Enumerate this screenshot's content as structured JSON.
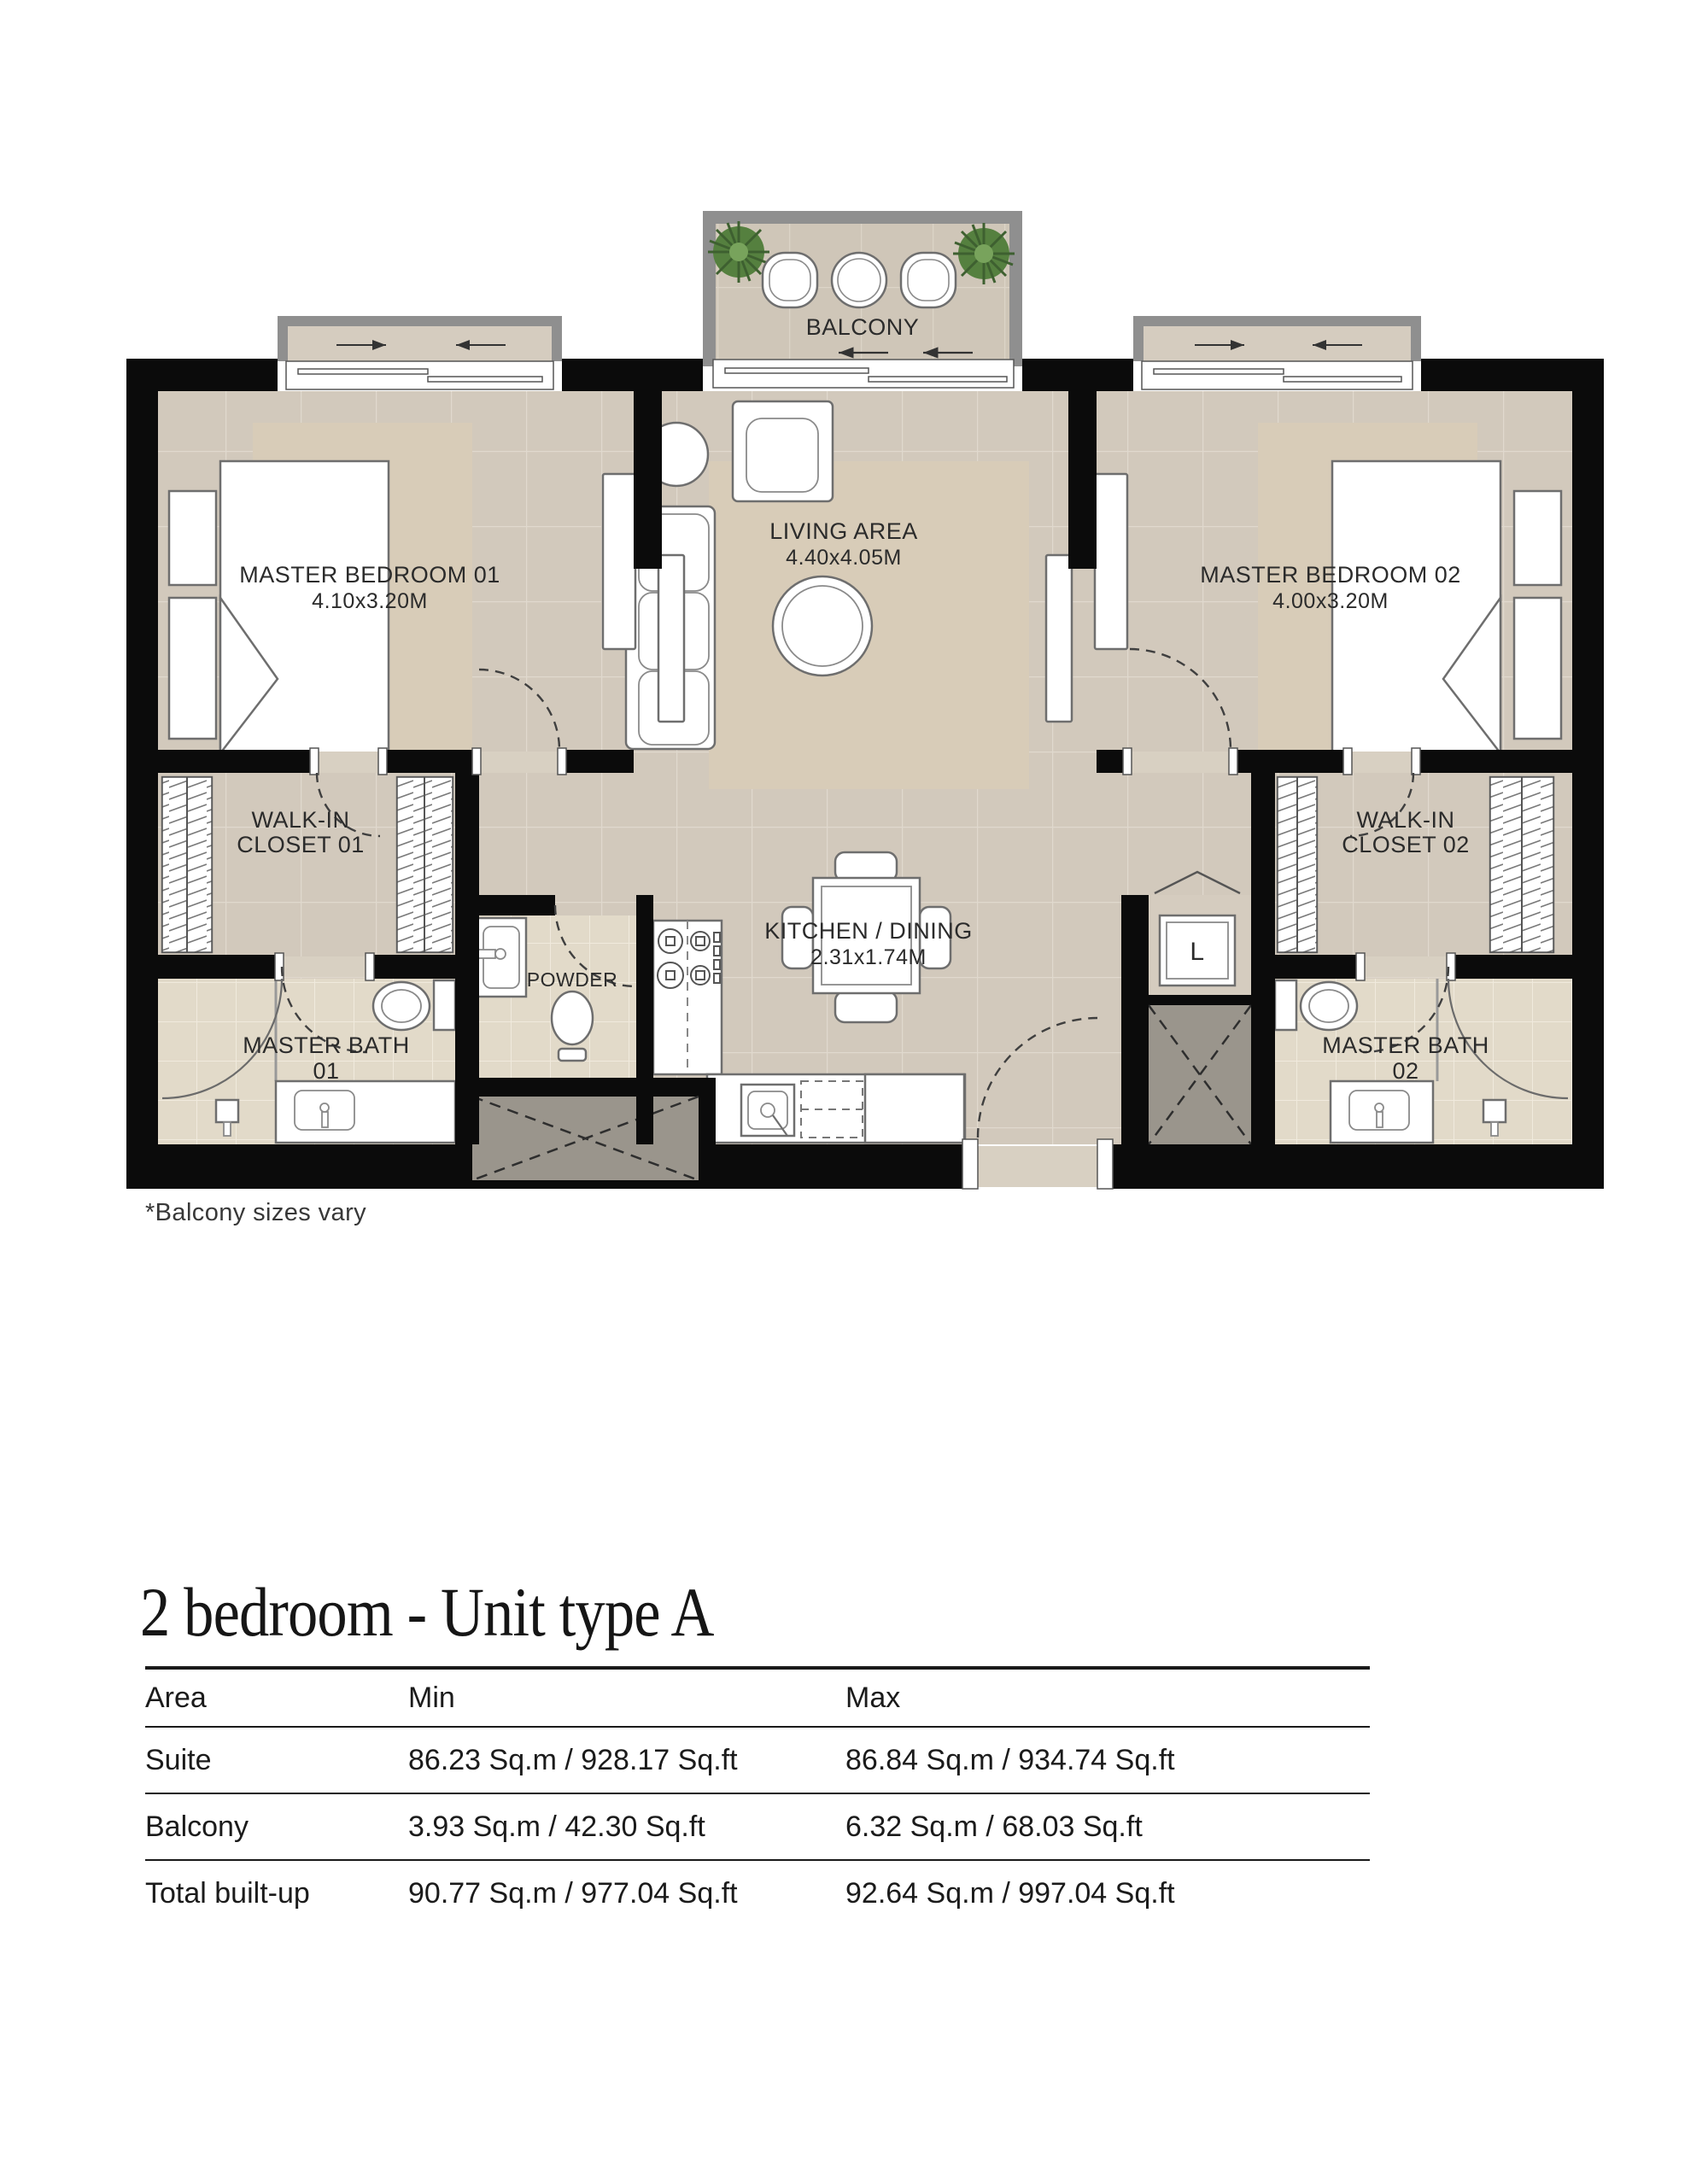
{
  "floor_plan": {
    "note": "*Balcony sizes vary",
    "rooms": {
      "balcony": {
        "label": "BALCONY"
      },
      "master_bedroom_1": {
        "name": "MASTER BEDROOM 01",
        "dims": "4.10x3.20M"
      },
      "living_area": {
        "name": "LIVING AREA",
        "dims": "4.40x4.05M"
      },
      "master_bedroom_2": {
        "name": "MASTER BEDROOM 02",
        "dims": "4.00x3.20M"
      },
      "walk_in_closet_1": {
        "line1": "WALK-IN",
        "line2": "CLOSET 01"
      },
      "walk_in_closet_2": {
        "line1": "WALK-IN",
        "line2": "CLOSET 02"
      },
      "kitchen_dining": {
        "name": "KITCHEN / DINING",
        "dims": "2.31x1.74M"
      },
      "powder": {
        "name": "POWDER"
      },
      "master_bath_1": {
        "line1": "MASTER BATH",
        "line2": "01"
      },
      "master_bath_2": {
        "line1": "MASTER BATH",
        "line2": "02"
      },
      "laundry": {
        "label": "L"
      }
    },
    "colors": {
      "wall": "#0b0b0b",
      "floor_tile": "#d2c9bc",
      "rug": "#d8ccb8",
      "bath_tile": "#e2dac9",
      "balcony_frame_gray": "#8f8f8f",
      "shaft_gray": "#9a958c",
      "plant_green": "#55803f",
      "label_text": "#2b2b2b"
    }
  },
  "section": {
    "title": "2 bedroom - Unit type A"
  },
  "table": {
    "headers": [
      "Area",
      "Min",
      "Max"
    ],
    "rows": [
      {
        "area": "Suite",
        "min": "86.23 Sq.m / 928.17 Sq.ft",
        "max": "86.84 Sq.m / 934.74 Sq.ft"
      },
      {
        "area": "Balcony",
        "min": "3.93 Sq.m / 42.30 Sq.ft",
        "max": "6.32 Sq.m / 68.03 Sq.ft"
      },
      {
        "area": "Total built-up",
        "min": "90.77 Sq.m / 977.04 Sq.ft",
        "max": "92.64 Sq.m / 997.04 Sq.ft"
      }
    ]
  }
}
